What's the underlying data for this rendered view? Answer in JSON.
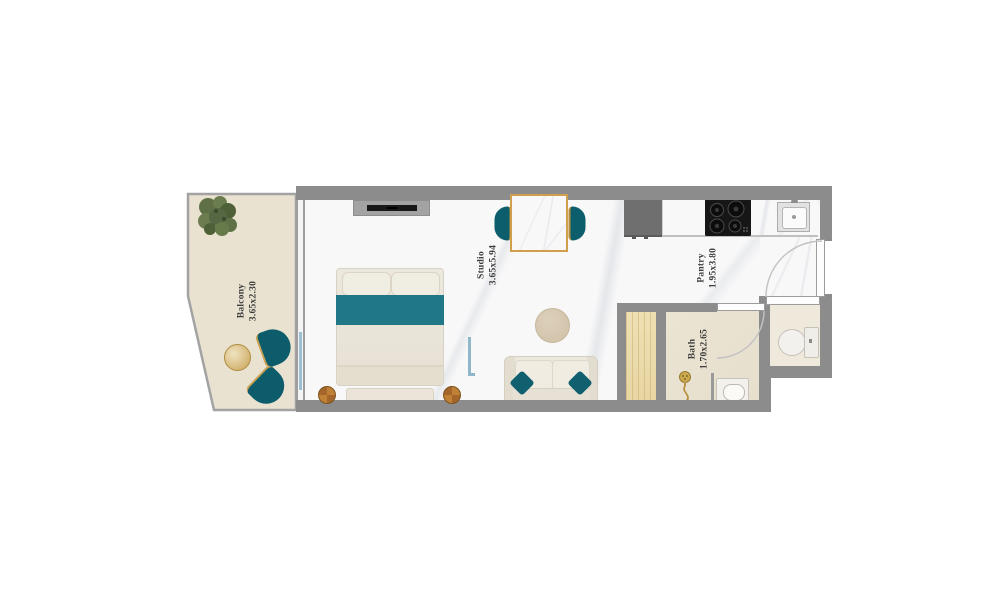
{
  "floorplan": {
    "rooms": [
      {
        "name": "Balcony",
        "dimensions": "3.65x2.30"
      },
      {
        "name": "Studio",
        "dimensions": "3.65x5.94"
      },
      {
        "name": "Pantry",
        "dimensions": "1.95x3.80"
      },
      {
        "name": "Bath",
        "dimensions": "1.70x2.65"
      }
    ],
    "colors": {
      "wall": "#8c8c8c",
      "teal_accent": "#1f7787",
      "gold_accent": "#c9a254",
      "studio_floor": "#f8f8f9",
      "balcony_floor": "#e9e2d1",
      "bath_floor": "#ebe3d1",
      "wood": "#ecdcae"
    },
    "furniture": {
      "balcony": [
        "potted-plant",
        "lounge-chair",
        "lounge-chair",
        "side-table"
      ],
      "studio": [
        "tv-unit",
        "double-bed",
        "nightstand",
        "nightstand",
        "dining-table",
        "dining-chair",
        "dining-chair",
        "round-rug",
        "sofa",
        "glass-partition"
      ],
      "pantry": [
        "refrigerator",
        "countertop",
        "gas-stove",
        "kitchen-sink",
        "entry-door"
      ],
      "bath": [
        "wardrobe",
        "shower",
        "vanity-sink",
        "toilet",
        "bath-door",
        "wc-door"
      ]
    }
  }
}
